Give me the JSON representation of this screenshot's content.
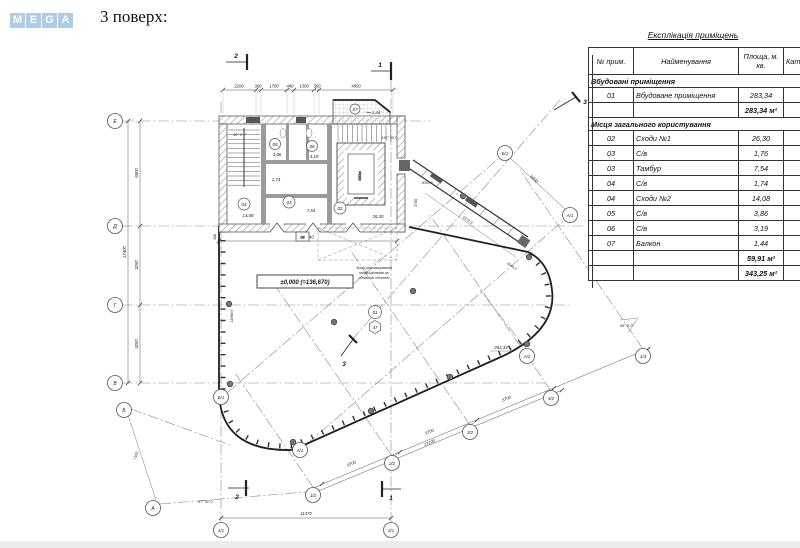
{
  "page": {
    "logo_letters": [
      "M",
      "E",
      "G",
      "A"
    ],
    "title": "3 поверх:"
  },
  "table": {
    "title": "Експлікація приміщень",
    "headers": {
      "num": "№ прим.",
      "name": "Найменування",
      "area": "Площа, м. кв.",
      "cat": "Кат."
    },
    "sections": [
      {
        "label": "Вбудовані приміщення",
        "rows": [
          {
            "num": "01",
            "name": "Вбудоване приміщення",
            "area": "283,34",
            "cat": ""
          }
        ],
        "subtotal": "283,34 м²"
      },
      {
        "label": "Місця загального користування",
        "rows": [
          {
            "num": "02",
            "name": "Сходи №1",
            "area": "26,30",
            "cat": ""
          },
          {
            "num": "03",
            "name": "С/в",
            "area": "1,76",
            "cat": ""
          },
          {
            "num": "03",
            "name": "Тамбур",
            "area": "7,54",
            "cat": ""
          },
          {
            "num": "04",
            "name": "С/в",
            "area": "1,74",
            "cat": ""
          },
          {
            "num": "04",
            "name": "Сходи №2",
            "area": "14,08",
            "cat": ""
          },
          {
            "num": "05",
            "name": "С/в",
            "area": "3,86",
            "cat": ""
          },
          {
            "num": "06",
            "name": "С/в",
            "area": "3,19",
            "cat": ""
          },
          {
            "num": "07",
            "name": "Балкон",
            "area": "1,44",
            "cat": ""
          }
        ],
        "subtotal": "59,91 м²"
      }
    ],
    "total": "343,25 м²"
  },
  "plan": {
    "level_mark": "±0,000 (=136,670)",
    "area_main": "283,34",
    "zone_note_1": "Зона розташування",
    "zone_note_2": "кондиціонерів за",
    "zone_note_3": "зйомною стелею",
    "dim_top_1": "2200",
    "dim_top_2": "300",
    "dim_top_3": "1700",
    "dim_top_4": "440",
    "dim_top_5": "1300",
    "dim_top_6": "300",
    "dim_top_7": "4900",
    "dim_left_1": "6900",
    "dim_left_2": "5250",
    "dim_left_3": "5250",
    "dim_left_total": "17400",
    "dim_bottom": "11370",
    "dim_core": "11740",
    "dim_diag_1": "5700",
    "dim_diag_2": "5700",
    "dim_diag_3": "5700",
    "dim_diag_total": "17100",
    "dim_wing": "6900",
    "dim_wing_len": "6171,3",
    "dim_wing_len2": "2646,3",
    "dim_wing_w": "3093,8",
    "dim_wing_h": "3700",
    "dim_ba": "7100",
    "dim_left_wall": "11968,9",
    "dim_small": "300",
    "angle_90": "90° 0' 0\"",
    "angle_136": "136° 30' 0\"",
    "angle_67": "67° 30' 0\"",
    "angle_66": "66° 0' 0\"",
    "axis_e": "Е",
    "axis_d": "Д",
    "axis_g": "Г",
    "axis_v": "В",
    "axis_b": "Б",
    "axis_a": "А",
    "axis_11": "1/1",
    "axis_21": "2/1",
    "axis_12": "1/2",
    "axis_22": "2/2",
    "axis_32": "3/2",
    "axis_42": "4/2",
    "axis_13": "1/3",
    "axis_b1": "Б/1",
    "axis_a1": "А/1",
    "axis_a2": "А/2",
    "section_1": "1",
    "section_2": "2",
    "section_3": "3",
    "room_01": "01",
    "room_02": "02",
    "room_03": "03",
    "room_04": "04",
    "room_05": "05",
    "room_06": "06",
    "room_07": "07",
    "room_08": "08",
    "marker_47": "47",
    "area_02": "26,30",
    "area_03": "7,54",
    "area_03b": "1,74",
    "area_04": "14,08",
    "area_05": "3,86",
    "area_06": "3,19",
    "area_07": "1,44",
    "elevator": "630кг"
  }
}
